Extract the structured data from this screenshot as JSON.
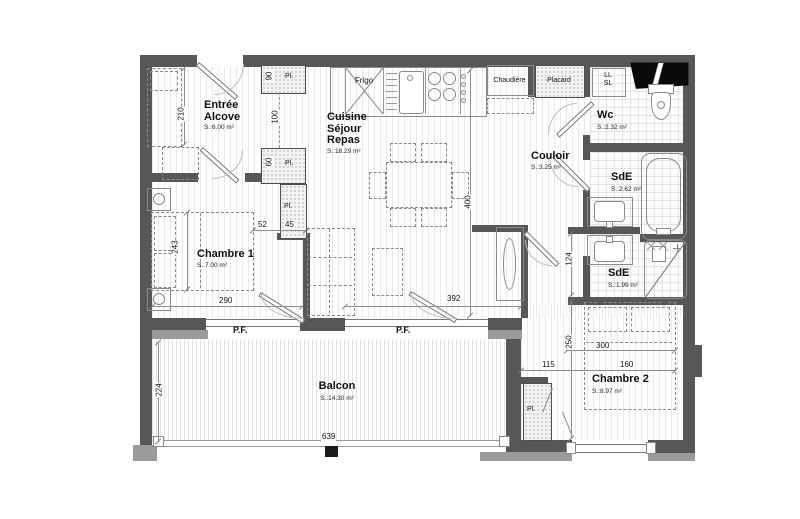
{
  "rooms": {
    "entree": {
      "name": "Entrée\nAlcove",
      "area": "S.:6.00 m²"
    },
    "chambre1": {
      "name": "Chambre 1",
      "area": "S.:7.00 m²"
    },
    "cuisine": {
      "name": "Cuisine\nSéjour\nRepas",
      "area": "S.:18.29 m²"
    },
    "couloir": {
      "name": "Couloir",
      "area": "S.:3.25 m²"
    },
    "wc": {
      "name": "Wc",
      "area": "S.:2.32 m²"
    },
    "sde1": {
      "name": "SdE",
      "area": "S.:2.62 m²"
    },
    "sde2": {
      "name": "SdE",
      "area": "S.:1.99 m²"
    },
    "chambre2": {
      "name": "Chambre 2",
      "area": "S.:8.97 m²"
    },
    "balcon": {
      "name": "Balcon",
      "area": "S.:14.30 m²"
    }
  },
  "fixtures": {
    "frigo": "Frigo",
    "chaudiere": "Chaudière",
    "placard": "Placard",
    "lave_linge": "LL\nSL",
    "closet": "Pl.",
    "window_door": "P.F."
  },
  "dimensions": {
    "d210": "210",
    "d100": "100",
    "d90": "90",
    "d60": "60",
    "d52": "52",
    "d45": "45",
    "d243": "243",
    "d290": "290",
    "d400": "400",
    "d392": "392",
    "d124": "124",
    "d224": "224",
    "d639": "639",
    "d115": "115",
    "d250": "250",
    "d300": "300",
    "d160": "160"
  },
  "colors": {
    "wall": "#575757",
    "wall_light": "#9b9b9b",
    "line": "#8f8f8f",
    "text": "#111111"
  }
}
